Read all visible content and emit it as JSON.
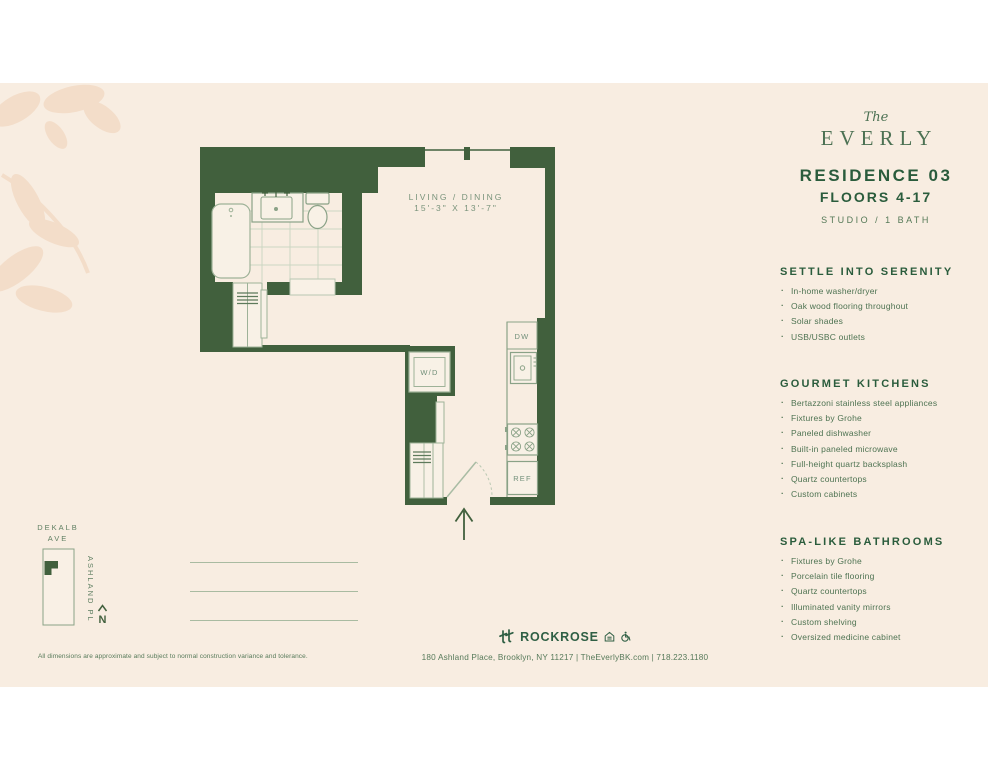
{
  "brand": {
    "the": "The",
    "name": "EVERLY"
  },
  "residence": {
    "title": "RESIDENCE 03",
    "floors": "FLOORS 4-17",
    "type": "STUDIO / 1 BATH"
  },
  "sections": [
    {
      "heading": "SETTLE INTO SERENITY",
      "items": [
        "In-home washer/dryer",
        "Oak wood flooring throughout",
        "Solar shades",
        "USB/USBC outlets"
      ]
    },
    {
      "heading": "GOURMET KITCHENS",
      "items": [
        "Bertazzoni stainless steel appliances",
        "Fixtures by Grohe",
        "Paneled dishwasher",
        "Built-in paneled microwave",
        "Full-height quartz backsplash",
        "Quartz countertops",
        "Custom cabinets"
      ]
    },
    {
      "heading": "SPA-LIKE BATHROOMS",
      "items": [
        "Fixtures by Grohe",
        "Porcelain tile flooring",
        "Quartz countertops",
        "Illuminated vanity mirrors",
        "Custom shelving",
        "Oversized medicine cabinet"
      ]
    }
  ],
  "floorplan": {
    "room_label_line1": "LIVING / DINING",
    "room_label_line2": "15'-3\" X 13'-7\"",
    "wd_label": "W/D",
    "dw_label": "DW",
    "ref_label": "REF"
  },
  "map": {
    "street_top_line1": "DEKALB",
    "street_top_line2": "AVE",
    "street_side": "ASHLAND PL",
    "north_label": "N"
  },
  "footer": {
    "disclaimer": "All dimensions are approximate and subject to normal construction variance and tolerance.",
    "logo": "ROCKROSE",
    "address": "180 Ashland Place, Brooklyn, NY 11217  |  TheEverlyBK.com  |  718.223.1180"
  },
  "colors": {
    "background": "#f8ede1",
    "wall_green": "#41603d",
    "heading_green": "#2a5c3c",
    "body_green": "#4e7352",
    "fixture_stroke": "#9eb298",
    "leaf": "#f3ddc9"
  }
}
